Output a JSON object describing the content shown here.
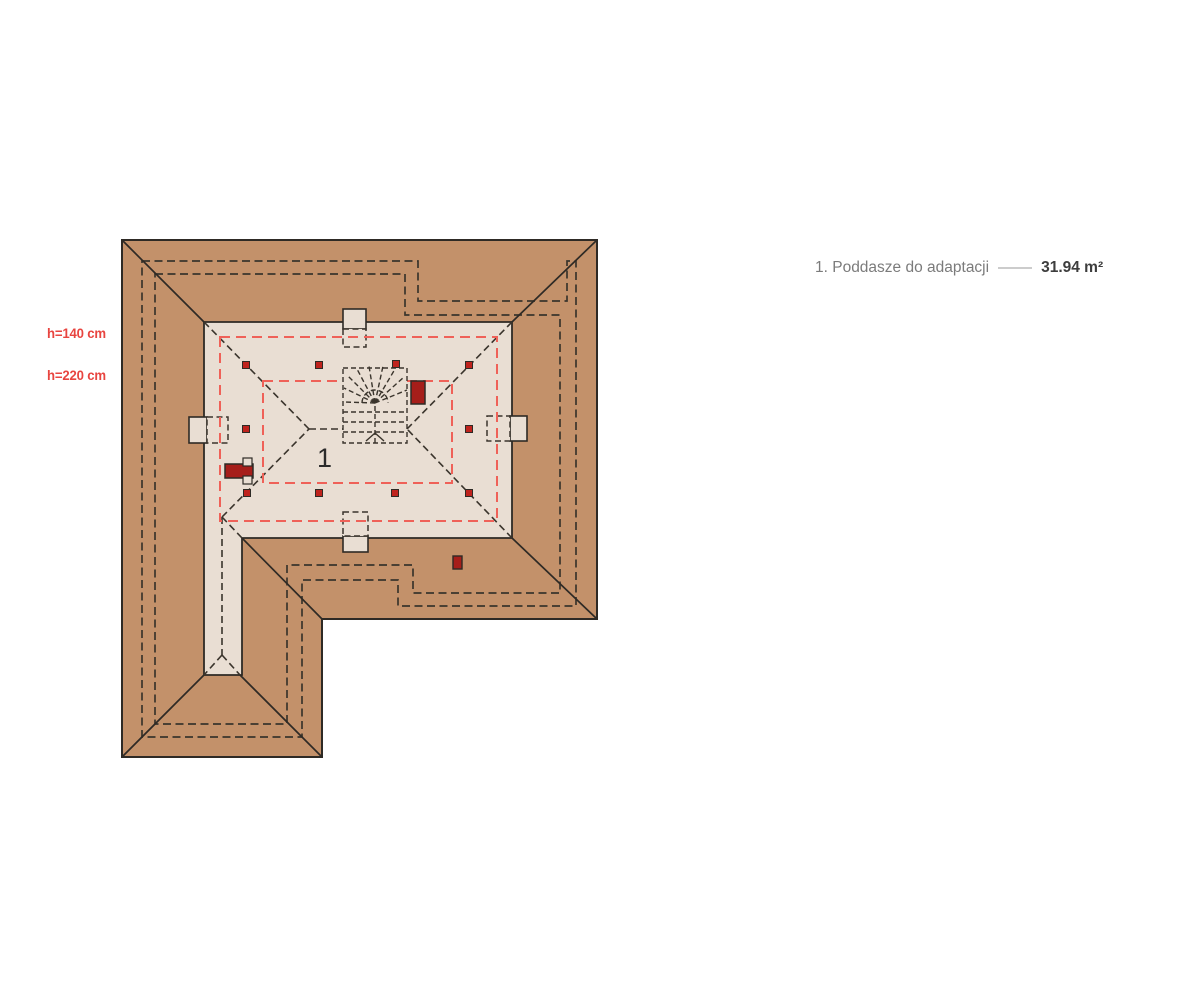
{
  "legend": {
    "item_label": "1. Poddasze do adaptacji",
    "area_value": "31.94 m²"
  },
  "plan": {
    "room_number": "1",
    "height_label_140": "h=140 cm",
    "height_label_220": "h=220 cm"
  },
  "colors": {
    "roof": "#c3916a",
    "floor": "#e9ded3",
    "line": "#2e2a25",
    "dash": "#3a342c",
    "red-dash": "#ef6158",
    "chimney": "#a61e1a",
    "post": "#bf231d",
    "label-red": "#e84540",
    "legend-text": "#7b7b7b",
    "legend-value": "#3d3d3d",
    "legend-line": "#cccccc",
    "bg": "#ffffff"
  }
}
